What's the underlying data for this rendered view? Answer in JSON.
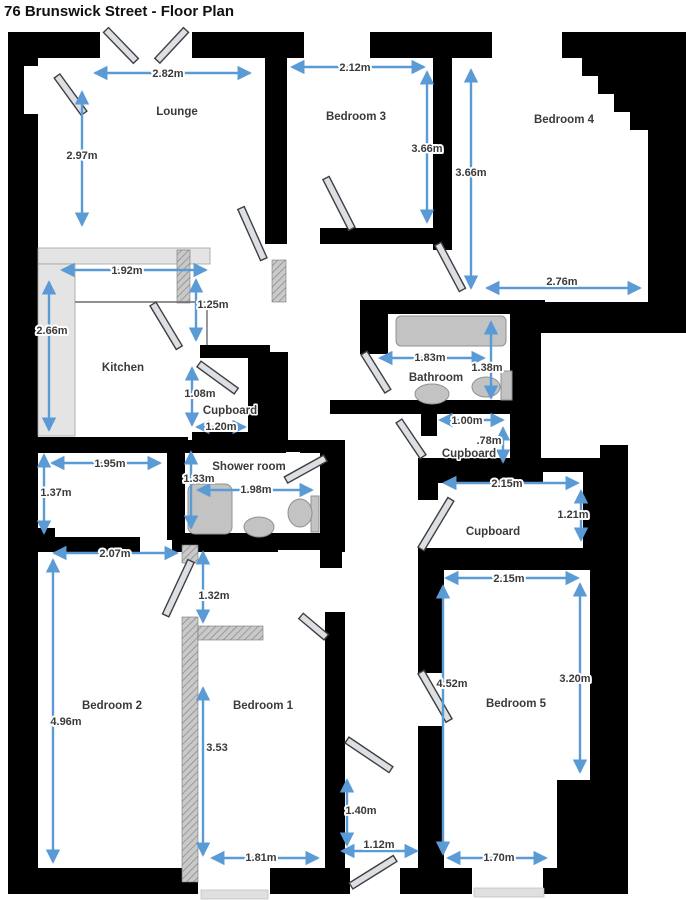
{
  "title": "76 Brunswick Street - Floor Plan",
  "colors": {
    "wall": "#000000",
    "dimension_blue": "#5b9bd5",
    "door_gray": "#dcdfe3",
    "fixture_gray": "#c3c3c3"
  },
  "rooms": {
    "lounge": {
      "name": "Lounge",
      "width": "2.82m",
      "height": "2.97m"
    },
    "bedroom3": {
      "name": "Bedroom 3",
      "width": "2.12m",
      "height": "3.66m"
    },
    "bedroom4": {
      "name": "Bedroom 4",
      "height": "3.66m",
      "width": "2.76m"
    },
    "kitchen": {
      "name": "Kitchen",
      "top": "1.92m",
      "right": "1.25m",
      "left": "2.66m"
    },
    "kitchen_cupboard": {
      "name": "Cupboard",
      "height": "1.08m",
      "width": "1.20m"
    },
    "bathroom": {
      "name": "Bathroom",
      "width": "1.83m",
      "height": "1.38m"
    },
    "landing_cupboard": {
      "name": "Cupboard",
      "width": "1.00m",
      "height": ".78m"
    },
    "hall": {
      "width": "1.95m",
      "height": "1.37m"
    },
    "shower_room": {
      "name": "Shower room",
      "height": "1.33m",
      "width": "1.98m"
    },
    "right_cupboard": {
      "name": "Cupboard",
      "width": "2.15m",
      "height": "1.21m"
    },
    "bedroom2": {
      "name": "Bedroom 2",
      "width": "2.07m",
      "height": "4.96m"
    },
    "bedroom1": {
      "name": "Bedroom 1",
      "lobby": "1.32m",
      "height": "3.53",
      "width": "1.81m"
    },
    "bedroom5": {
      "name": "Bedroom 5",
      "top": "2.15m",
      "left": "4.52m",
      "right": "3.20m",
      "bottom": "1.70m"
    },
    "rear_hall": {
      "height": "1.40m",
      "width": "1.12m"
    }
  }
}
